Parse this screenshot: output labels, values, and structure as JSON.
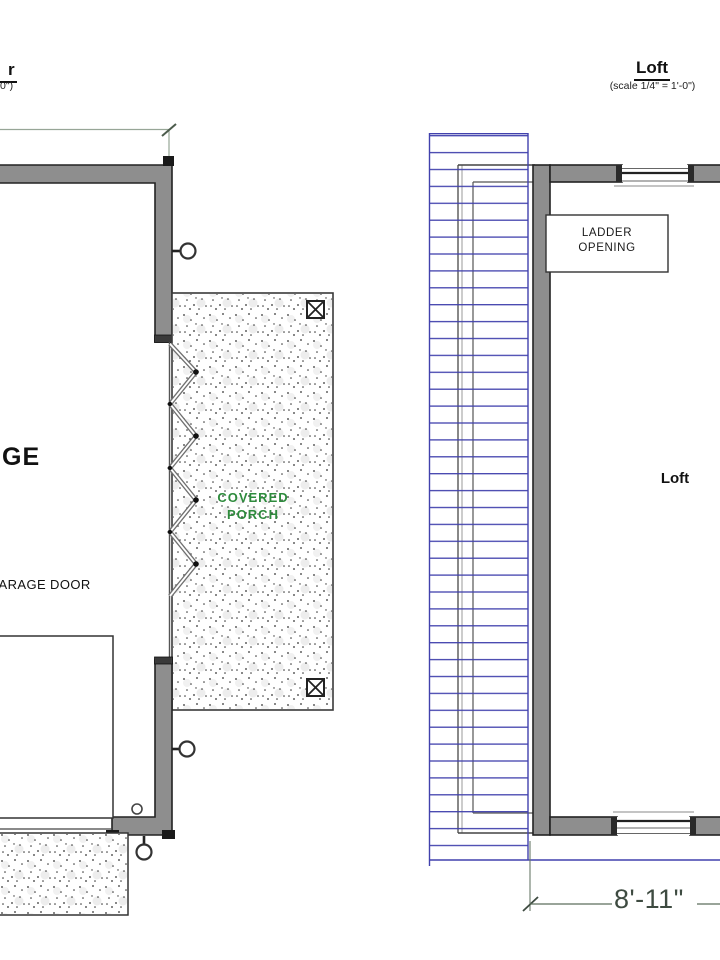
{
  "left_plan": {
    "title_fragment": "r",
    "scale_fragment": "0\")",
    "room_label": "GE",
    "door_label": "GARAGE DOOR",
    "porch_label": "COVERED PORCH"
  },
  "right_plan": {
    "title": "Loft",
    "scale": "(scale 1/4\" = 1'-0\")",
    "ladder_label": "LADDER OPENING",
    "room_label": "Loft",
    "dimension_width": "8'-11\""
  },
  "colors": {
    "wall_fill": "#8e8e8e",
    "outline": "#222222",
    "roof_hatch_blue": "#4141ad",
    "dimension_green": "#5c6e5c",
    "dimension_text": "#3e4b41",
    "porch_text_green": "#2e8b3d"
  }
}
